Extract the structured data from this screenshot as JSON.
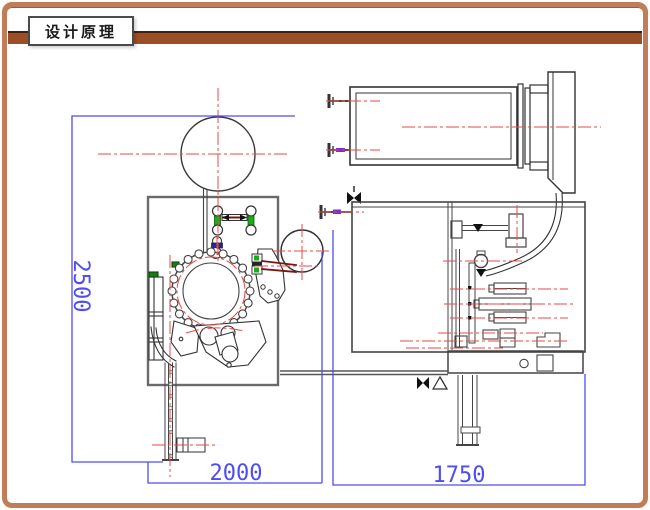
{
  "header": {
    "title": "设计原理"
  },
  "dimensions": {
    "height_mm": "2500",
    "left_width_mm": "2000",
    "right_width_mm": "1750"
  },
  "colors": {
    "frame_brown": "#c07d58",
    "bar_brown": "#9c4f27",
    "dimension_blue": "#4d4df2",
    "centerline_red": "#e84a4a",
    "outline_dark": "#3a3a3a",
    "body_gray": "#6a6a6a",
    "accent_green": "#1cab1c",
    "accent_navy": "#28288e",
    "accent_purple": "#7a2fd4",
    "rod_dark_red": "#7c1414"
  }
}
